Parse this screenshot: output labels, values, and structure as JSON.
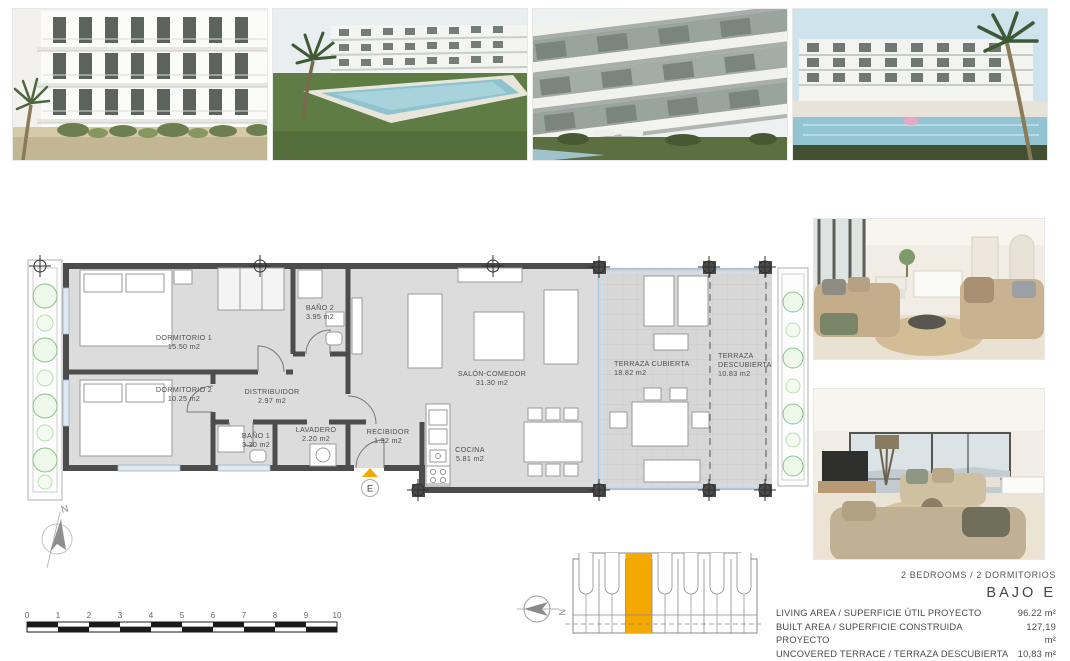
{
  "plan": {
    "north_label": "N",
    "entry_label": "E",
    "accent_color": "#F5A800",
    "rooms": {
      "dormitorio1": {
        "name": "DORMITORIO 1",
        "area": "15.50 m2"
      },
      "dormitorio2": {
        "name": "DORMITORIO 2",
        "area": "10.25 m2"
      },
      "bano2": {
        "name": "BAÑO 2",
        "area": "3.95 m2"
      },
      "distribuidor": {
        "name": "DISTRIBUIDOR",
        "area": "2.97 m2"
      },
      "bano1": {
        "name": "BAÑO 1",
        "area": "3.30 m2"
      },
      "lavadero": {
        "name": "LAVADERO",
        "area": "2.20 m2"
      },
      "recibidor": {
        "name": "RECIBIDOR",
        "area": "1.92 m2"
      },
      "cocina": {
        "name": "COCINA",
        "area": "5.81 m2"
      },
      "salon": {
        "name": "SALÓN-COMEDOR",
        "area": "31.30 m2"
      },
      "terraza_cubierta": {
        "name": "TERRAZA CUBIERTA",
        "area": "18.82 m2"
      },
      "terraza_descubierta": {
        "line1": "TERRAZA",
        "line2": "DESCUBIERTA",
        "area": "10.83 m2"
      }
    }
  },
  "scalebar": {
    "ticks": [
      "0",
      "1",
      "2",
      "3",
      "4",
      "5",
      "6",
      "7",
      "8",
      "9",
      "10"
    ]
  },
  "keyplan": {
    "north_label": "N"
  },
  "summary": {
    "bedrooms_line": "2 BEDROOMS / 2 DORMITORIOS",
    "unit_label": "BAJO E",
    "rows": [
      {
        "label": "LIVING AREA / SUPERFICIE ÚTIL PROYECTO",
        "value": "96.22 m²"
      },
      {
        "label": "BUILT AREA / SUPERFICIE CONSTRUIDA PROYECTO",
        "value": "127,19 m²"
      },
      {
        "label": "UNCOVERED TERRACE / TERRAZA DESCUBIERTA",
        "value": "10,83 m²"
      }
    ]
  }
}
